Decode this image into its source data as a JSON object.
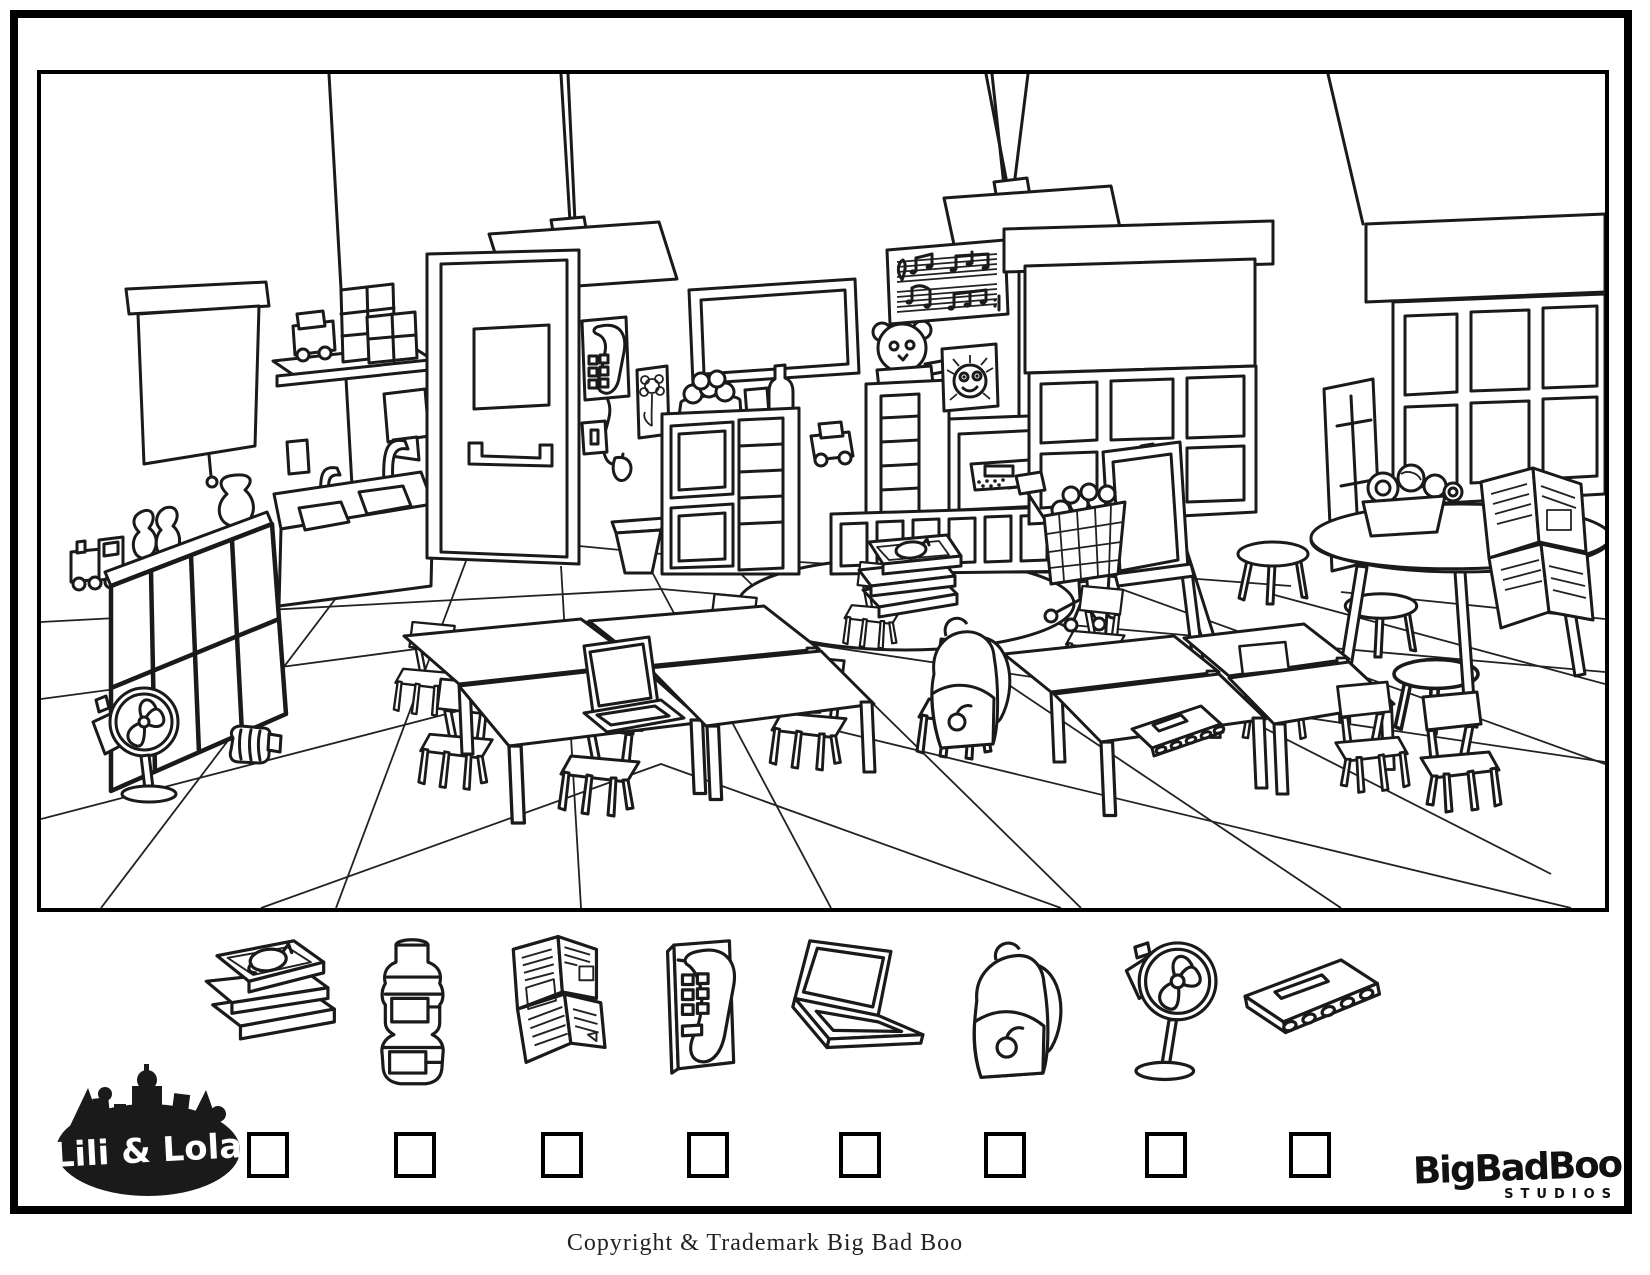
{
  "page": {
    "copyright": "Copyright & Trademark Big Bad Boo",
    "background": "#ffffff",
    "border_color": "#000000"
  },
  "branding": {
    "left_logo_text": "Lili & Lola",
    "right_logo_text": "BigBadBoo",
    "right_logo_subtext": "STUDIOS"
  },
  "worksheet": {
    "kind": "find-the-hidden-objects coloring page",
    "scene": "classroom line-art",
    "items": [
      {
        "icon": "stack-of-books-icon",
        "checked": false
      },
      {
        "icon": "water-bottle-icon",
        "checked": false
      },
      {
        "icon": "newspaper-icon",
        "checked": false
      },
      {
        "icon": "wall-telephone-icon",
        "checked": false
      },
      {
        "icon": "laptop-icon",
        "checked": false
      },
      {
        "icon": "backpack-icon",
        "checked": false
      },
      {
        "icon": "standing-fan-icon",
        "checked": false
      },
      {
        "icon": "spiral-notebook-icon",
        "checked": false
      }
    ],
    "scene_objects": [
      "projection-screen",
      "toy-shelf",
      "blocks",
      "toy-train",
      "sink-counter",
      "soap-dispenser",
      "paper-towel-dispenser",
      "cubby-shelf",
      "standing-fan",
      "water-bottle",
      "door",
      "pendant-lamp",
      "wall-telephone",
      "flower-picture",
      "light-switch",
      "trash-can",
      "wall-tv",
      "shelf-unit",
      "bowl-of-balls",
      "teddy-bear",
      "music-poster",
      "sun-drawing",
      "toy-truck",
      "window-with-blind",
      "easel",
      "shopping-cart",
      "stools",
      "growth-chart",
      "round-table",
      "yarn-basket",
      "newspaper",
      "student-tables",
      "chairs",
      "rug",
      "stack-of-books",
      "laptop",
      "backpack",
      "spiral-notebook"
    ]
  }
}
